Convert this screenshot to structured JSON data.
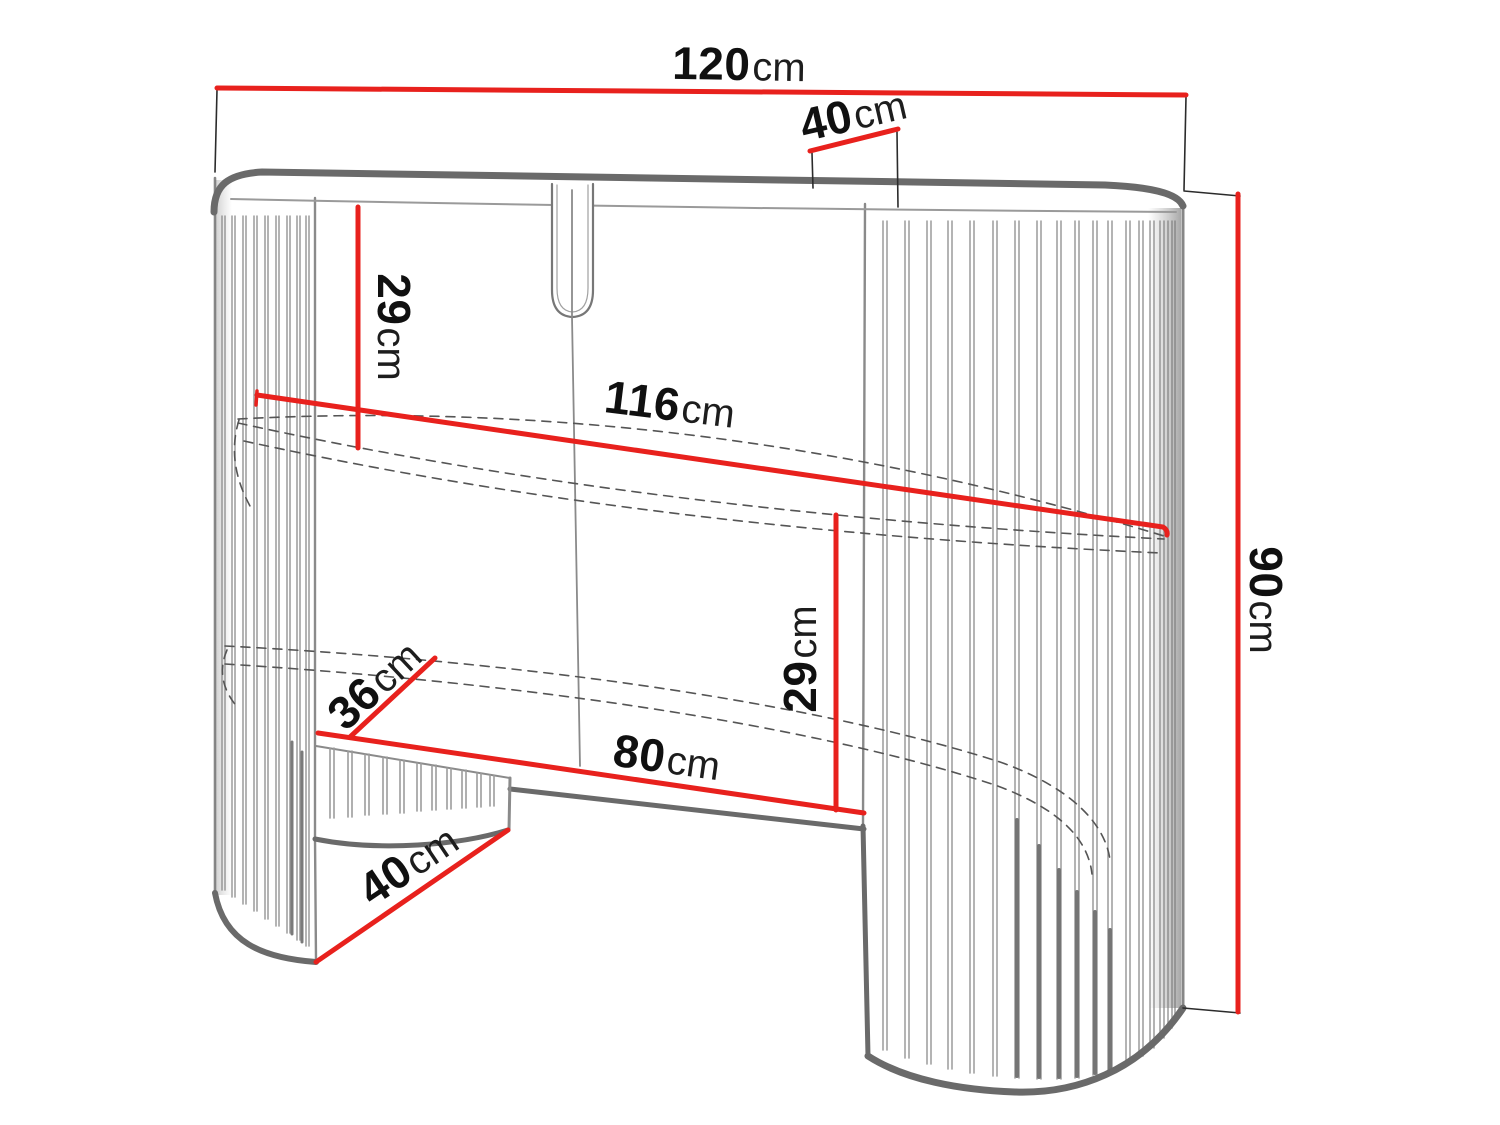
{
  "figure": {
    "title": "furniture-dimension-diagram",
    "colors": {
      "dimension_red": "#e8211d",
      "outline_gray": "#6a6a6a",
      "slat_gray": "#9a9a9a",
      "text": "#101010"
    }
  },
  "dims": {
    "top_width": {
      "value": "120",
      "unit": "cm"
    },
    "top_depth": {
      "value": "40",
      "unit": "cm"
    },
    "top_clearance": {
      "value": "29",
      "unit": "cm"
    },
    "inner_width": {
      "value": "116",
      "unit": "cm"
    },
    "height": {
      "value": "90",
      "unit": "cm"
    },
    "opening_height": {
      "value": "29",
      "unit": "cm"
    },
    "shelf_depth": {
      "value": "36",
      "unit": "cm"
    },
    "opening_width": {
      "value": "80",
      "unit": "cm"
    },
    "base_depth": {
      "value": "40",
      "unit": "cm"
    }
  }
}
